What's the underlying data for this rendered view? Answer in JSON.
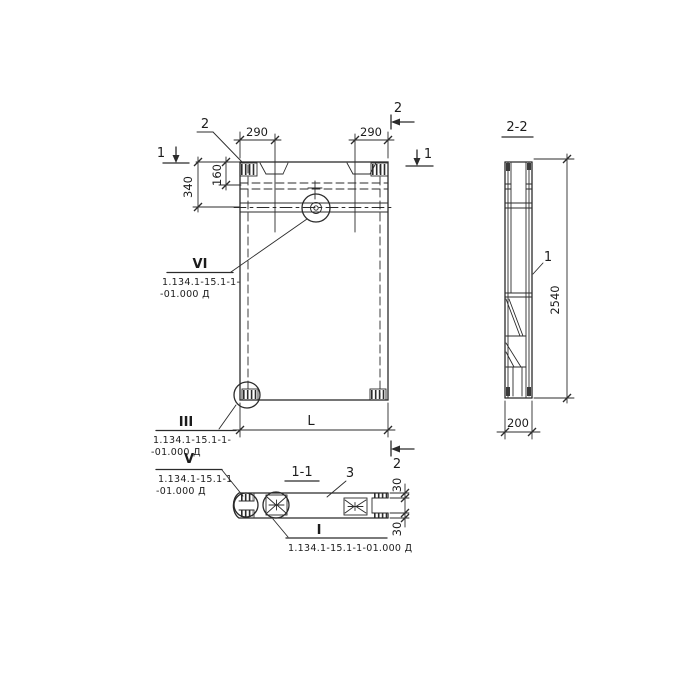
{
  "front_view": {
    "dim_290_left": "290",
    "dim_290_right": "290",
    "dim_340": "340",
    "dim_160": "160",
    "dim_length": "L",
    "mark_1_left": "1",
    "mark_1_right": "1",
    "mark_2_top": "2",
    "mark_2_bottom": "2",
    "callout_2_label": "2",
    "detail_vi": {
      "numeral": "VI",
      "doc_line1": "1.134.1-15.1-1-",
      "doc_line2": "-01.000 Д"
    },
    "detail_iii": {
      "numeral": "III",
      "doc_line1": "1.134.1-15.1-1-",
      "doc_line2": "-01.000 Д"
    }
  },
  "section_1_1": {
    "title": "1-1",
    "part_label_3": "3",
    "dim_30_top": "30",
    "dim_30_bottom": "30",
    "detail_v": {
      "numeral": "V",
      "doc_line1": "1.134.1-15.1-1",
      "doc_line2": "-01.000 Д"
    },
    "detail_i": {
      "numeral": "I",
      "doc_line1": "1.134.1-15.1-1-01.000 Д"
    }
  },
  "section_2_2": {
    "title": "2-2",
    "dim_height": "2540",
    "dim_width": "200",
    "part_label_1": "1"
  }
}
